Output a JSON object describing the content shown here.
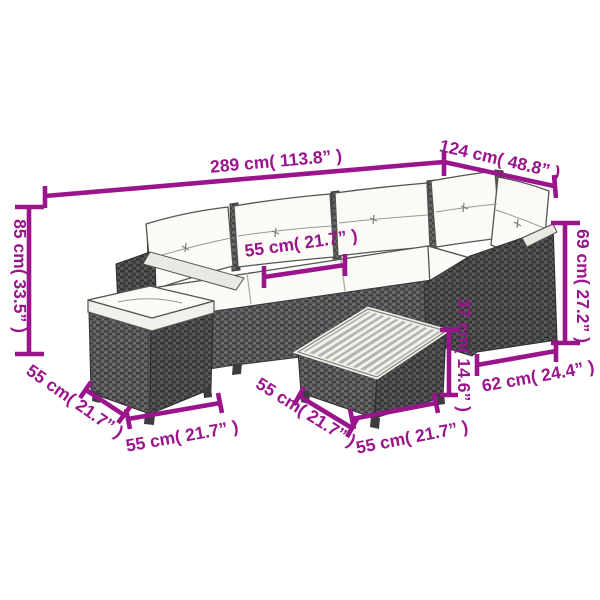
{
  "figure": {
    "type": "product-dimension-diagram",
    "subject": "8 piece garden corner sofa set with cushions, footstool and slatted coffee table",
    "background_color": "#ffffff",
    "accent_color": "#9A148C",
    "rattan_color": "#59595b",
    "cushion_color": "#fbfaf6"
  },
  "annotations": {
    "sofa_total_width": "289 cm( 113.8” )",
    "sofa_right_depth": "124 cm( 48.8” )",
    "sofa_height": "85 cm( 33.5” )",
    "seat_width": "55 cm( 21.7” )",
    "ottoman_depth_left": "55 cm( 21.7” )",
    "ottoman_width_front": "55 cm( 21.7” )",
    "table_depth_left": "55 cm( 21.7” )",
    "table_width_front": "55 cm( 21.7” )",
    "table_height": "37 cm( 14.6” )",
    "armrest_height": "69 cm( 27.2” )",
    "end_section_depth": "62 cm( 24.4” )"
  }
}
